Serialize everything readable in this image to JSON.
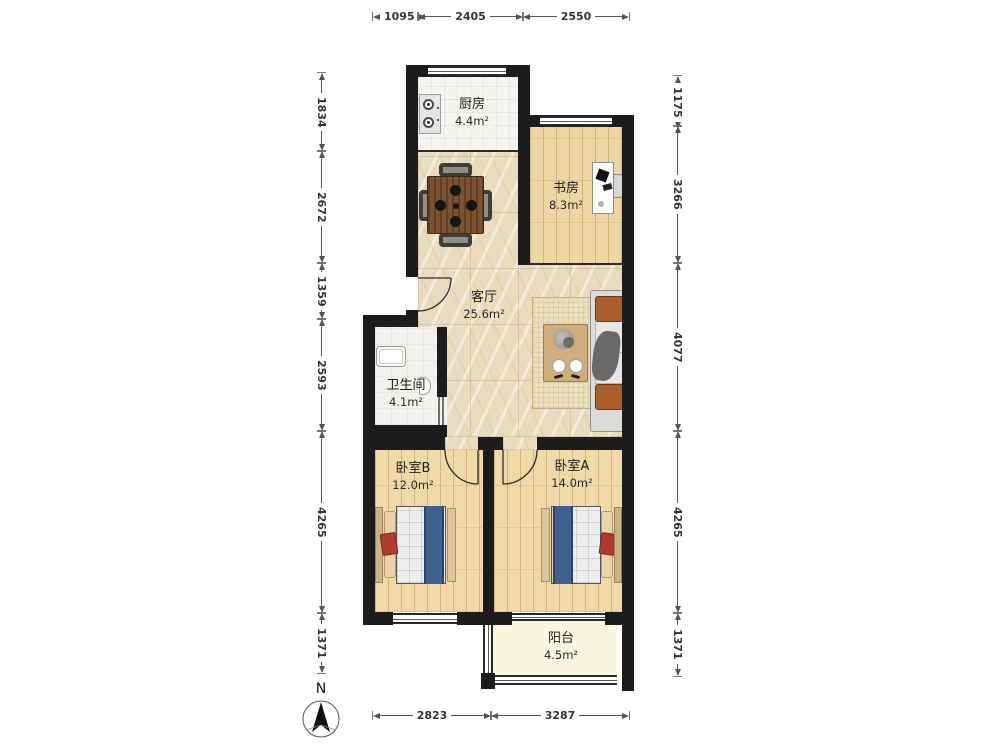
{
  "plan": {
    "rooms": {
      "kitchen": {
        "name": "厨房",
        "area": "4.4m²"
      },
      "study": {
        "name": "书房",
        "area": "8.3m²"
      },
      "living": {
        "name": "客厅",
        "area": "25.6m²"
      },
      "bathroom": {
        "name": "卫生间",
        "area": "4.1m²"
      },
      "bedroom_b": {
        "name": "卧室B",
        "area": "12.0m²"
      },
      "bedroom_a": {
        "name": "卧室A",
        "area": "14.0m²"
      },
      "balcony": {
        "name": "阳台",
        "area": "4.5m²"
      }
    },
    "dimensions": {
      "top": [
        "1095",
        "2405",
        "2550"
      ],
      "bottom": [
        "2823",
        "3287"
      ],
      "left": [
        "1834",
        "2672",
        "1359",
        "2593",
        "4265",
        "1371"
      ],
      "right": [
        "1175",
        "3266",
        "4077",
        "4265",
        "1371"
      ]
    },
    "compass": {
      "label": "N"
    },
    "colors": {
      "wall": "#1c1c1c",
      "marble_floor": "#e9dbbe",
      "wood_floor": "#f0d9a6",
      "balcony_floor": "#f8f6df",
      "bed_runner": "#40608f",
      "accent_pillow": "#b23a2e",
      "sofa_cushion": "#a95d29",
      "table_wood": "#7b5331"
    }
  }
}
